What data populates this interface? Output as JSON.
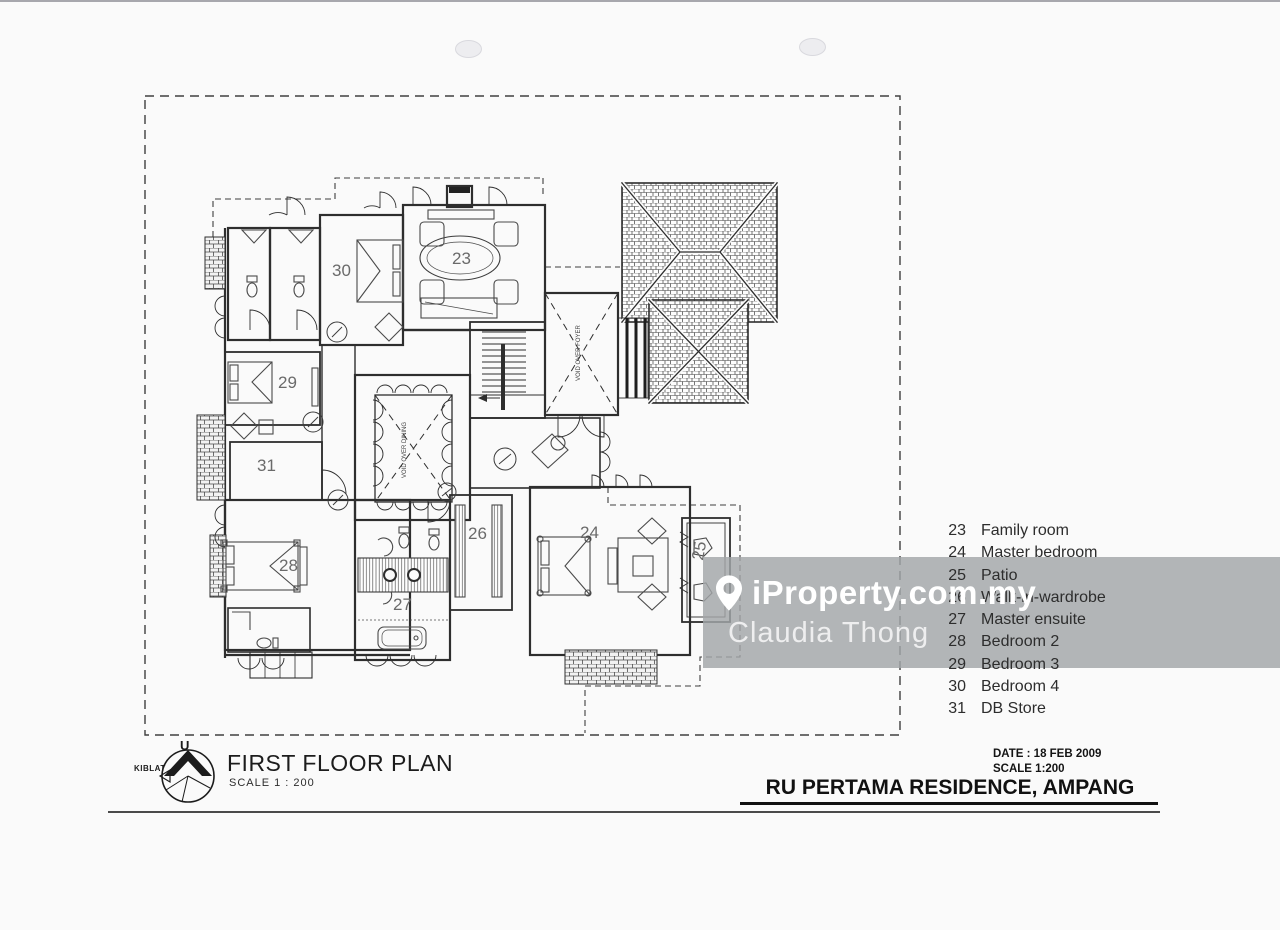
{
  "watermark": {
    "brand": "iProperty.com.my",
    "agent": "Claudia Thong",
    "band_color": "rgba(162,166,168,0.82)"
  },
  "legend": {
    "items": [
      {
        "number": "23",
        "label": "Family room"
      },
      {
        "number": "24",
        "label": "Master bedroom"
      },
      {
        "number": "25",
        "label": "Patio"
      },
      {
        "number": "26",
        "label": "Walk-in-wardrobe"
      },
      {
        "number": "27",
        "label": "Master ensuite"
      },
      {
        "number": "28",
        "label": "Bedroom 2"
      },
      {
        "number": "29",
        "label": "Bedroom 3"
      },
      {
        "number": "30",
        "label": "Bedroom 4"
      },
      {
        "number": "31",
        "label": "DB Store"
      }
    ]
  },
  "plan": {
    "rooms": [
      {
        "number": "23"
      },
      {
        "number": "24"
      },
      {
        "number": "25"
      },
      {
        "number": "26"
      },
      {
        "number": "27"
      },
      {
        "number": "28"
      },
      {
        "number": "29"
      },
      {
        "number": "30"
      },
      {
        "number": "31"
      }
    ],
    "voids": [
      {
        "label": "VOID OVER DINING"
      },
      {
        "label": "VOID OVER FOYER"
      }
    ]
  },
  "title_block": {
    "title": "FIRST FLOOR PLAN",
    "scale": "SCALE 1 : 200",
    "north_letter": "U",
    "kiblat_label": "KIBLAT"
  },
  "footer": {
    "date": "DATE : 18 FEB 2009",
    "scale": "SCALE 1:200",
    "project": "RU PERTAMA RESIDENCE, AMPANG"
  },
  "colors": {
    "ink": "#2e2e2e",
    "room_label": "#6a6a6a"
  }
}
